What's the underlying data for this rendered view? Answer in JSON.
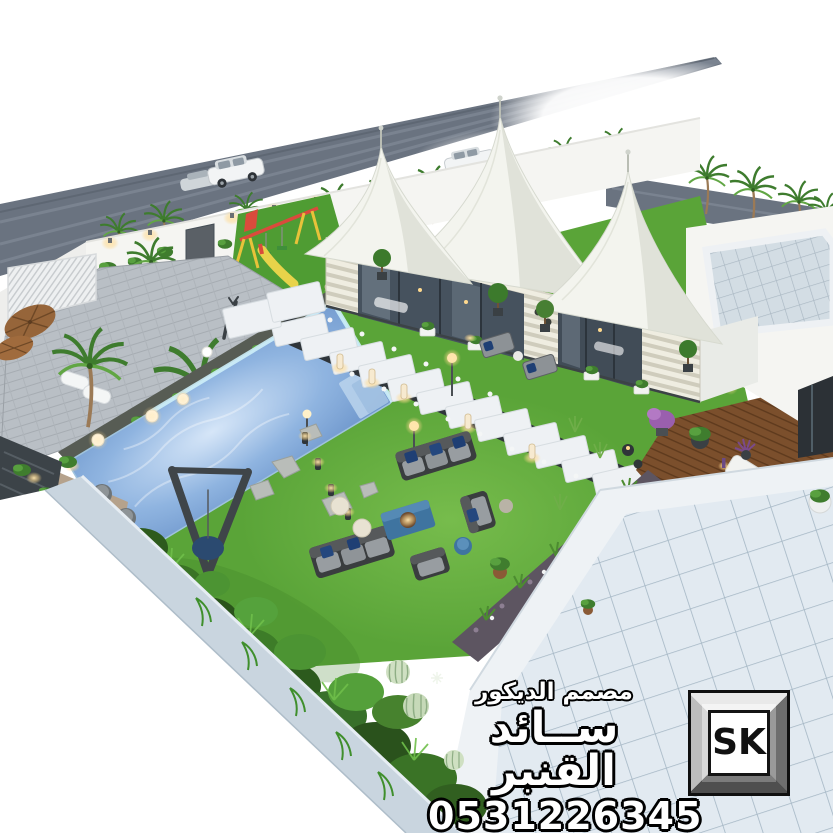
{
  "watermark": {
    "title": "مصمم الديكور",
    "name": "ســائد القنبر",
    "phone": "0531226345"
  },
  "logo": {
    "text": "SK"
  },
  "colors": {
    "background": "#ffffff",
    "road": "#6a7380",
    "road_stripe": "#8a93a0",
    "wall": "#f5f5f2",
    "grass": "#5aa438",
    "grass_dark": "#3e7f27",
    "pool": "#8fb4e0",
    "pool_light": "#d6e6f8",
    "patio": "#b6bcc2",
    "stone": "#eef1f4",
    "tent": "#f3f4ee",
    "tent_shade": "#d9dcd2",
    "deck": "#7b4f2c",
    "tile_roof": "#dfe8ef",
    "outer_wall": "#c9d5df",
    "glow": "#ffdf9e",
    "watermark_fill": "#ffffff",
    "watermark_outline": "#000000"
  }
}
